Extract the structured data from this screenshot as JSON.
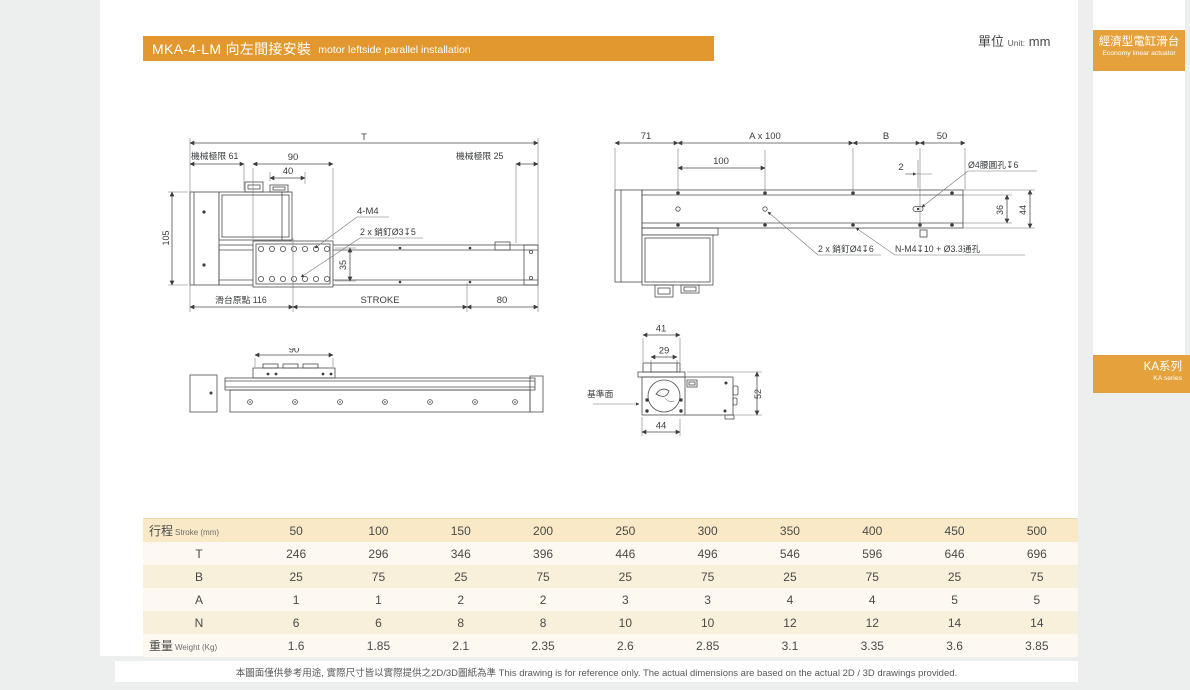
{
  "meta": {
    "unit_zh": "單位",
    "unit_en": "Unit:",
    "unit_value": "mm"
  },
  "header": {
    "model_title": "MKA-4-LM 向左間接安裝",
    "subtitle_en": "motor leftside parallel installation"
  },
  "sidebar": {
    "tab_category_zh": "經濟型電缸滑台",
    "tab_category_en": "Economy linear actuator",
    "tab_series_zh": "KA系列",
    "tab_series_en": "KA series"
  },
  "drawings": {
    "top_view": {
      "t": "T",
      "limit_left": "機械極限 61",
      "d90": "90",
      "d40": "40",
      "limit_right": "機械極限 25",
      "d105": "105",
      "m4": "4-M4",
      "pin3": "2 x 銷釘Ø3↧5",
      "d35": "35",
      "origin": "滑台原點 116",
      "stroke": "STROKE",
      "d80": "80"
    },
    "bottom_view": {
      "d71": "71",
      "ax100": "A x 100",
      "b": "B",
      "d50": "50",
      "d100": "100",
      "d2": "2",
      "slot": "Ø4腰圓孔↧6",
      "d36": "36",
      "d44": "44",
      "pin4": "2 x 銷釘Ø4↧6",
      "nm4": "N-M4↧10 + Ø3.3通孔"
    },
    "side_view": {
      "d90": "90"
    },
    "end_view": {
      "d41": "41",
      "d29": "29",
      "d52": "52",
      "d44": "44",
      "datum": "基準面"
    }
  },
  "table": {
    "header": {
      "label_zh": "行程",
      "label_en": "Stroke (mm)",
      "values": [
        "50",
        "100",
        "150",
        "200",
        "250",
        "300",
        "350",
        "400",
        "450",
        "500"
      ]
    },
    "rows": [
      {
        "label_zh": "T",
        "label_en": "",
        "values": [
          "246",
          "296",
          "346",
          "396",
          "446",
          "496",
          "546",
          "596",
          "646",
          "696"
        ]
      },
      {
        "label_zh": "B",
        "label_en": "",
        "values": [
          "25",
          "75",
          "25",
          "75",
          "25",
          "75",
          "25",
          "75",
          "25",
          "75"
        ]
      },
      {
        "label_zh": "A",
        "label_en": "",
        "values": [
          "1",
          "1",
          "2",
          "2",
          "3",
          "3",
          "4",
          "4",
          "5",
          "5"
        ]
      },
      {
        "label_zh": "N",
        "label_en": "",
        "values": [
          "6",
          "6",
          "8",
          "8",
          "10",
          "10",
          "12",
          "12",
          "14",
          "14"
        ]
      },
      {
        "label_zh": "重量",
        "label_en": "Weight (Kg)",
        "values": [
          "1.6",
          "1.85",
          "2.1",
          "2.35",
          "2.6",
          "2.85",
          "3.1",
          "3.35",
          "3.6",
          "3.85"
        ]
      }
    ]
  },
  "footer": {
    "note": "本圖面僅供參考用途, 實際尺寸皆以實際提供之2D/3D圖紙為準 This drawing is for reference only. The actual dimensions are based on the actual 2D / 3D drawings provided."
  },
  "colors": {
    "accent_orange": "#e2982f",
    "tab_orange": "#e5a23c",
    "table_header": "#f9e9c6",
    "table_row_light": "#fdf9f0",
    "table_row_cream": "#f8f0da",
    "page_bg": "#ffffff",
    "canvas_bg": "#edefee"
  }
}
